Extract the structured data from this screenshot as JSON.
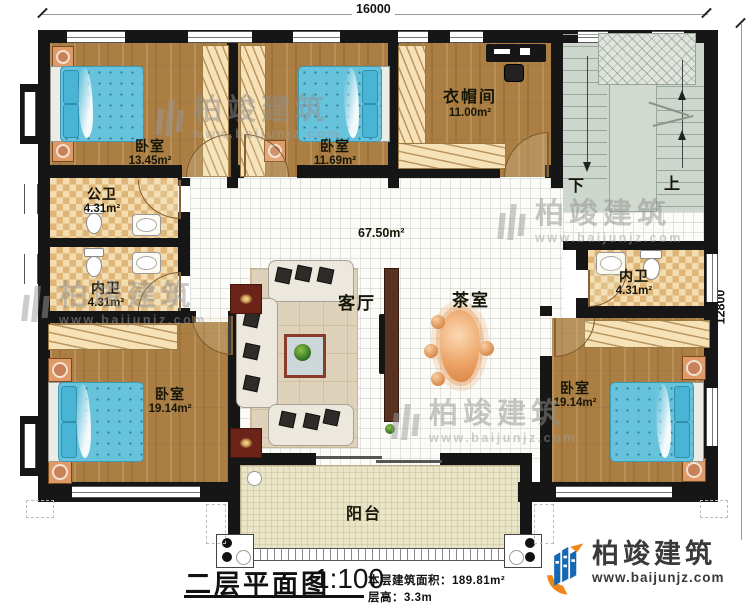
{
  "dimensions": {
    "width_top": "16000",
    "height_right": "12800"
  },
  "rooms": {
    "bedroom_top_left": {
      "label": "卧室",
      "area": "13.45m²"
    },
    "bedroom_top_mid": {
      "label": "卧室",
      "area": "11.69m²"
    },
    "cloakroom": {
      "label": "衣帽间",
      "area": "11.00m²"
    },
    "public_bath": {
      "label": "公卫",
      "area": "4.31m²"
    },
    "inner_bath_left": {
      "label": "内卫",
      "area": "4.31m²"
    },
    "inner_bath_right": {
      "label": "内卫",
      "area": "4.31m²"
    },
    "bedroom_bottom_left": {
      "label": "卧室",
      "area": "19.14m²"
    },
    "bedroom_bottom_right": {
      "label": "卧室",
      "area": "19.14m²"
    },
    "hall": {
      "area": "67.50m²"
    },
    "living_room": {
      "label": "客厅"
    },
    "tea_room": {
      "label": "茶室"
    },
    "balcony": {
      "label": "阳台"
    },
    "stairs": {
      "down_label": "下",
      "up_label": "上"
    }
  },
  "footer": {
    "title": "二层平面图",
    "scale": "1:100",
    "floor_area_label": "本层建筑面积：",
    "floor_area_value": "189.81m²",
    "floor_height_label": "层高：",
    "floor_height_value": "3.3m"
  },
  "brand": {
    "name": "柏竣建筑",
    "website": "www.baijunjz.com"
  },
  "watermark": {
    "name": "柏竣建筑",
    "website": "www.baijunjz.com"
  },
  "colors": {
    "wall": "#161616",
    "wood_floor": "#ab7f44",
    "bath_tile": "#f3ddb0",
    "bath_tile_alt": "#dfb678",
    "bed_blue": "#67c3dc",
    "stair_gray": "#ced7cd",
    "balcony_floor": "#ebe5c8",
    "brand_blue": "#1668b2",
    "brand_orange": "#f08519",
    "watermark_gray": "#8f8f8f"
  }
}
